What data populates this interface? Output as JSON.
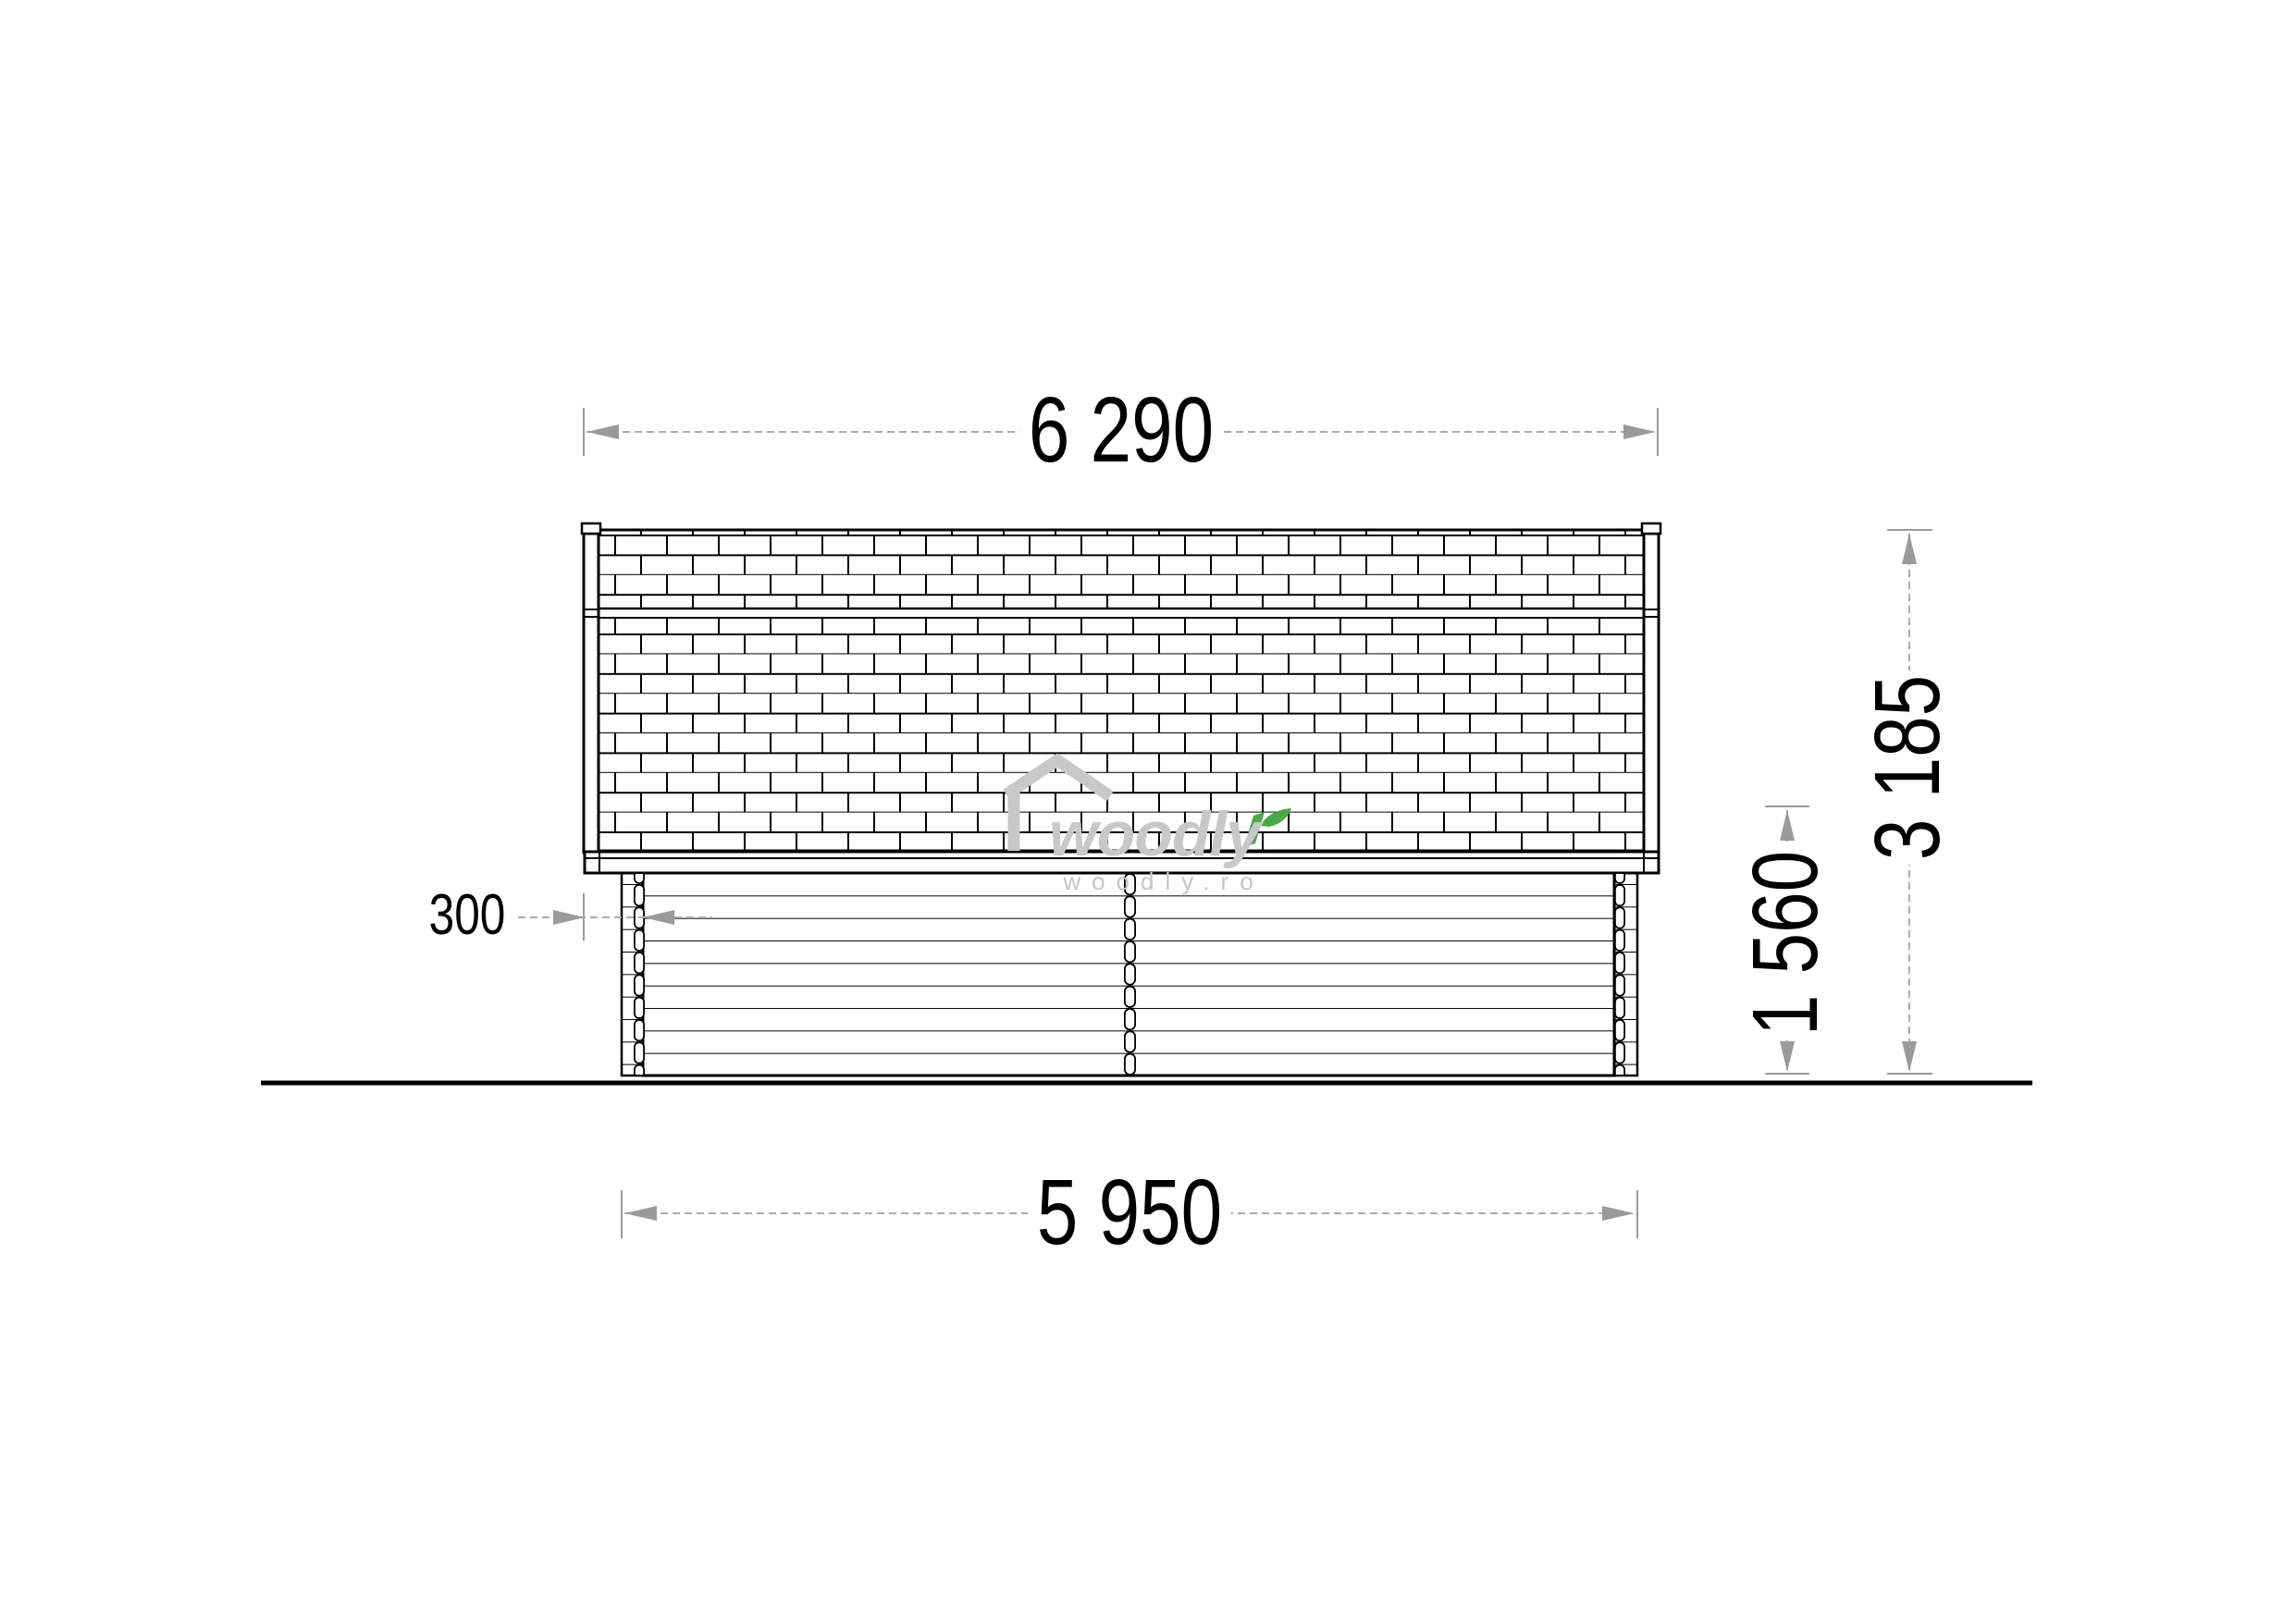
{
  "meta": {
    "title": "Wooden cabin side elevation drawing"
  },
  "dimensions": {
    "roof_width": "6 290",
    "wall_width": "5 950",
    "overhang": "300",
    "eave_height": "1 560",
    "total_height": "3 185"
  },
  "watermark": {
    "brand": "woodly",
    "site": "woodly.ro",
    "gray": "#c8c8c8",
    "green": "#4aa84a"
  },
  "colors": {
    "line": "#000000",
    "dimension": "#9a9a9a",
    "ground": "#000000"
  }
}
